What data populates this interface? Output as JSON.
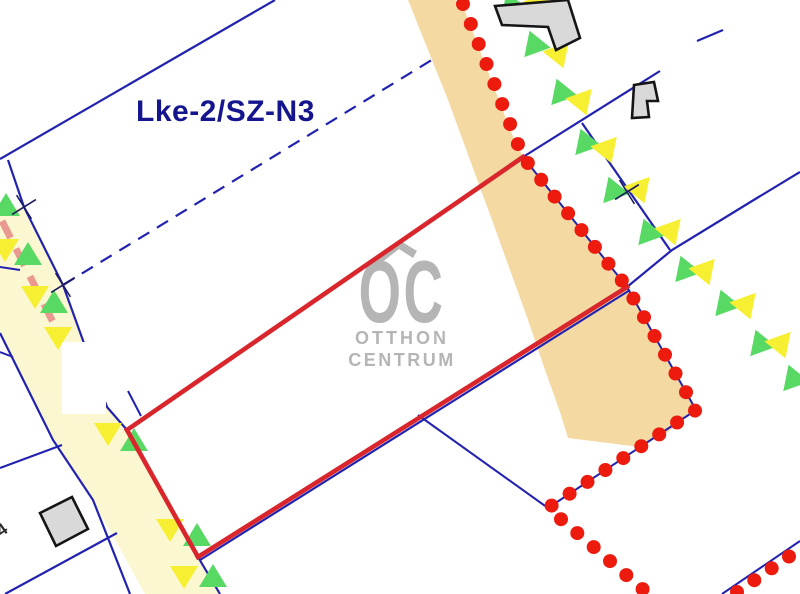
{
  "map": {
    "zone_label": "Lke-2/SZ-N3",
    "parcel_number_partial": "4",
    "watermark": {
      "logo_text": "OC",
      "line1": "OTTHON",
      "line2": "CENTRUM"
    },
    "colors": {
      "boundary": "#2222b0",
      "parcel_red": "#d8262c",
      "dot_red": "#ec1b0e",
      "green": "#57d964",
      "yellow": "#f6ef32",
      "main_band": "#f4daa2",
      "left_band": "#fbf7d0",
      "building_fill": "#d9d9d9",
      "building_stroke": "#151515",
      "cross": "#1a1a5e",
      "pink": "#e9998f",
      "label_blue": "#15158e",
      "watermark_gray": "#b5b5b5",
      "number_dark": "#2a2a2a",
      "mask_white": "#ffffff"
    },
    "features": {
      "bands": [
        {
          "name": "main-road-band",
          "fill": "#f4daa2",
          "points": "408,0 426,45 448,100 470,160 492,220 510,270 528,320 545,370 560,412 568,438 600,442 640,447 668,432 688,414 696,410 684,389 661,348 638,307 627,287 601,253 575,221 549,189 523,157 511,132 495,90 479,48 463,6 455,0"
        },
        {
          "name": "left-road-band",
          "fill": "#fbf7d0",
          "points": "0,206 8,210 24,207 63,285 107,407 127,430 198,557 220,594 145,594 93,500 53,440 0,333"
        }
      ],
      "boundary_lines": [
        {
          "name": "boundary-line-topleft",
          "pts": "0,159 275,0",
          "w": 2.2
        },
        {
          "name": "left-road-right-edge-line",
          "pts": "8,160 24,207 63,285 107,407 127,430 198,557 220,594",
          "w": 2.2
        },
        {
          "name": "left-road-left-edge-line",
          "pts": "0,333 53,440 93,500 130,594",
          "w": 2.2
        },
        {
          "name": "west-branch-line-1",
          "pts": "0,267 20,270",
          "w": 2
        },
        {
          "name": "west-branch-line-2",
          "pts": "0,352 13,357",
          "w": 2
        },
        {
          "name": "west-branch-line-3",
          "pts": "0,468 62,445",
          "w": 2
        },
        {
          "name": "west-branch-line-4",
          "pts": "5,594 117,533",
          "w": 2.2
        },
        {
          "name": "stub-line-above-west-corner",
          "pts": "128,391 141,416",
          "w": 2
        },
        {
          "name": "north-boundary-line",
          "pts": "523,157 660,71",
          "w": 2.2
        },
        {
          "name": "north-boundary-line-gap-piece",
          "pts": "697,41 723,30",
          "w": 2.2
        },
        {
          "name": "northeast-perpendicular-line",
          "pts": "582,123 670,250",
          "w": 2.2
        },
        {
          "name": "east-boundary-line",
          "pts": "627,287 672,250 757,198 800,172",
          "w": 2.2
        },
        {
          "name": "inner-split-line",
          "pts": "418,415 548,508",
          "w": 2
        },
        {
          "name": "parcel-bottom-cadastral-line",
          "pts": "200,560 630,290",
          "w": 2.2
        },
        {
          "name": "dotted-boundary-underlay-line",
          "pts": "523,157 627,287 696,410 548,508",
          "w": 2
        },
        {
          "name": "corner-dotted-underlay-line",
          "pts": "722,594 800,541",
          "w": 2
        },
        {
          "name": "long-dashed-boundary-line",
          "pts": "63,285 435,58",
          "w": 2.2,
          "dash": "13 9"
        }
      ],
      "pink_lines": [
        {
          "name": "pink-dashed-utility-line",
          "pts": "2,221 62,340",
          "w": 7,
          "dash": "19 12"
        }
      ],
      "white_patches": [
        {
          "name": "white-mask-on-road",
          "x": 62,
          "y": 342,
          "w": 44,
          "h": 72
        }
      ],
      "triangles": [
        {
          "x": 6,
          "y": 206,
          "c": "g",
          "o": "u",
          "r": 0
        },
        {
          "x": 5,
          "y": 249,
          "c": "y",
          "o": "d",
          "r": 0
        },
        {
          "x": 28,
          "y": 255,
          "c": "g",
          "o": "u",
          "r": 0
        },
        {
          "x": 35,
          "y": 296,
          "c": "y",
          "o": "d",
          "r": 0
        },
        {
          "x": 54,
          "y": 303,
          "c": "g",
          "o": "u",
          "r": 0
        },
        {
          "x": 58,
          "y": 337,
          "c": "y",
          "o": "d",
          "r": 0
        },
        {
          "x": 108,
          "y": 433,
          "c": "y",
          "o": "d",
          "r": 0
        },
        {
          "x": 134,
          "y": 441,
          "c": "g",
          "o": "u",
          "r": 0
        },
        {
          "x": 170,
          "y": 529,
          "c": "y",
          "o": "d",
          "r": 0
        },
        {
          "x": 197,
          "y": 536,
          "c": "g",
          "o": "u",
          "r": 0
        },
        {
          "x": 184,
          "y": 576,
          "c": "y",
          "o": "d",
          "r": 0
        },
        {
          "x": 213,
          "y": 577,
          "c": "g",
          "o": "u",
          "r": 0
        },
        {
          "x": 511,
          "y": 4,
          "c": "g",
          "o": "u",
          "r": -20
        },
        {
          "x": 540,
          "y": 6,
          "c": "y",
          "o": "d",
          "r": -20
        },
        {
          "x": 534,
          "y": 43,
          "c": "g",
          "o": "u",
          "r": -20
        },
        {
          "x": 559,
          "y": 56,
          "c": "y",
          "o": "d",
          "r": -20
        },
        {
          "x": 561,
          "y": 91,
          "c": "g",
          "o": "u",
          "r": -20
        },
        {
          "x": 582,
          "y": 103,
          "c": "y",
          "o": "d",
          "r": -20
        },
        {
          "x": 585,
          "y": 141,
          "c": "g",
          "o": "u",
          "r": -20
        },
        {
          "x": 607,
          "y": 151,
          "c": "y",
          "o": "d",
          "r": -20
        },
        {
          "x": 613,
          "y": 189,
          "c": "g",
          "o": "u",
          "r": -20
        },
        {
          "x": 640,
          "y": 191,
          "c": "y",
          "o": "d",
          "r": -20
        },
        {
          "x": 648,
          "y": 231,
          "c": "g",
          "o": "u",
          "r": -20
        },
        {
          "x": 671,
          "y": 233,
          "c": "y",
          "o": "d",
          "r": -20
        },
        {
          "x": 685,
          "y": 268,
          "c": "g",
          "o": "u",
          "r": -20
        },
        {
          "x": 705,
          "y": 273,
          "c": "y",
          "o": "d",
          "r": -20
        },
        {
          "x": 725,
          "y": 302,
          "c": "g",
          "o": "u",
          "r": -20
        },
        {
          "x": 746,
          "y": 307,
          "c": "y",
          "o": "d",
          "r": -20
        },
        {
          "x": 760,
          "y": 342,
          "c": "g",
          "o": "u",
          "r": -20
        },
        {
          "x": 781,
          "y": 346,
          "c": "y",
          "o": "d",
          "r": -20
        },
        {
          "x": 793,
          "y": 377,
          "c": "g",
          "o": "u",
          "r": -20
        }
      ],
      "red_parcel_lines": [
        {
          "name": "red-parcel-top-edge",
          "pts": "127,430 523,157"
        },
        {
          "name": "red-parcel-left-edge",
          "pts": "127,430 198,557"
        },
        {
          "name": "red-parcel-bottom-edge",
          "pts": "198,557 627,287"
        }
      ],
      "dot_chains": [
        {
          "name": "dotted-parcel-boundary-main",
          "spacing": 21.5,
          "path": [
            [
              463,
              4
            ],
            [
              523,
              157
            ],
            [
              627,
              287
            ],
            [
              696,
              410
            ],
            [
              548,
              508
            ],
            [
              646,
              592
            ]
          ]
        },
        {
          "name": "dotted-parcel-boundary-corner",
          "spacing": 21,
          "path": [
            [
              737,
              592
            ],
            [
              800,
              549
            ]
          ]
        }
      ],
      "crosses": [
        {
          "x": 24,
          "y": 207
        },
        {
          "x": 63,
          "y": 285
        },
        {
          "x": 627,
          "y": 192
        }
      ],
      "buildings": [
        {
          "name": "building-footprint-top",
          "points": "495,6 568,0 580,38 556,50 548,27 502,25"
        },
        {
          "name": "building-footprint-east",
          "points": "634,85 654,82 658,101 647,101 649,117 632,118"
        },
        {
          "name": "building-footprint-southwest",
          "points": "40,513 72,497 88,529 56,546"
        }
      ]
    }
  }
}
